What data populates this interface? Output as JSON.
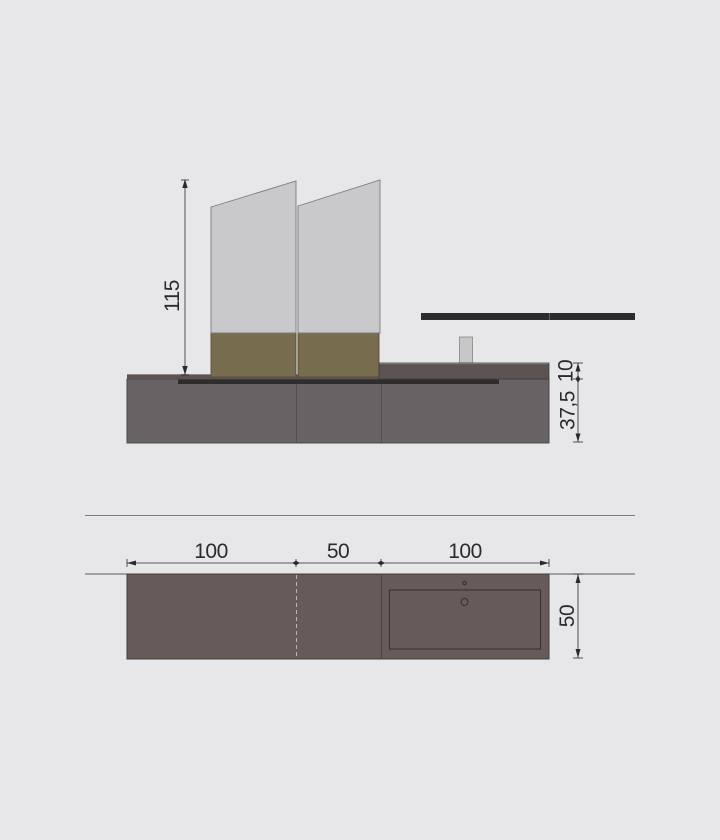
{
  "drawing": {
    "type": "furniture technical drawing, elevation and plan view of wall-hung vanity with two mirror units, shelf bar and integrated sink"
  },
  "elevation": {
    "labels": {
      "total_height": "115",
      "countertop_thickness": "10",
      "cabinet_height": "37,5"
    }
  },
  "plan": {
    "labels": {
      "section_left": "100",
      "section_middle": "50",
      "section_right": "100",
      "depth": "50"
    }
  },
  "colors": {
    "background": "#e7e7e9",
    "mirror_fill": "#c9c9cb",
    "mirror_stroke": "#7b7b7e",
    "band_fill": "#786c4e",
    "band_stroke": "#554f3a",
    "counter_fill": "#5d5352",
    "counter_stroke": "#403a39",
    "counter_highlight": "#8d8784",
    "cabinet_fill": "#676365",
    "cabinet_stroke": "#4b474a",
    "seam_color": "#524e51",
    "groove_fill": "#2e2d2b",
    "shelf_fill": "#2c2c2e",
    "shelf_divider": "#5d5d62",
    "faucet_fill": "#c7c7c7",
    "faucet_stroke": "#86868a",
    "separator_color": "#7c7b7f",
    "wall_line": "#5a595d",
    "plan_fill": "#665b59",
    "plan_stroke": "#433c3a",
    "plan_seam": "#4a4340",
    "dashed_line": "#b9b5b3",
    "sink_stroke": "#39332f",
    "dim_color": "#2b2b2d"
  }
}
